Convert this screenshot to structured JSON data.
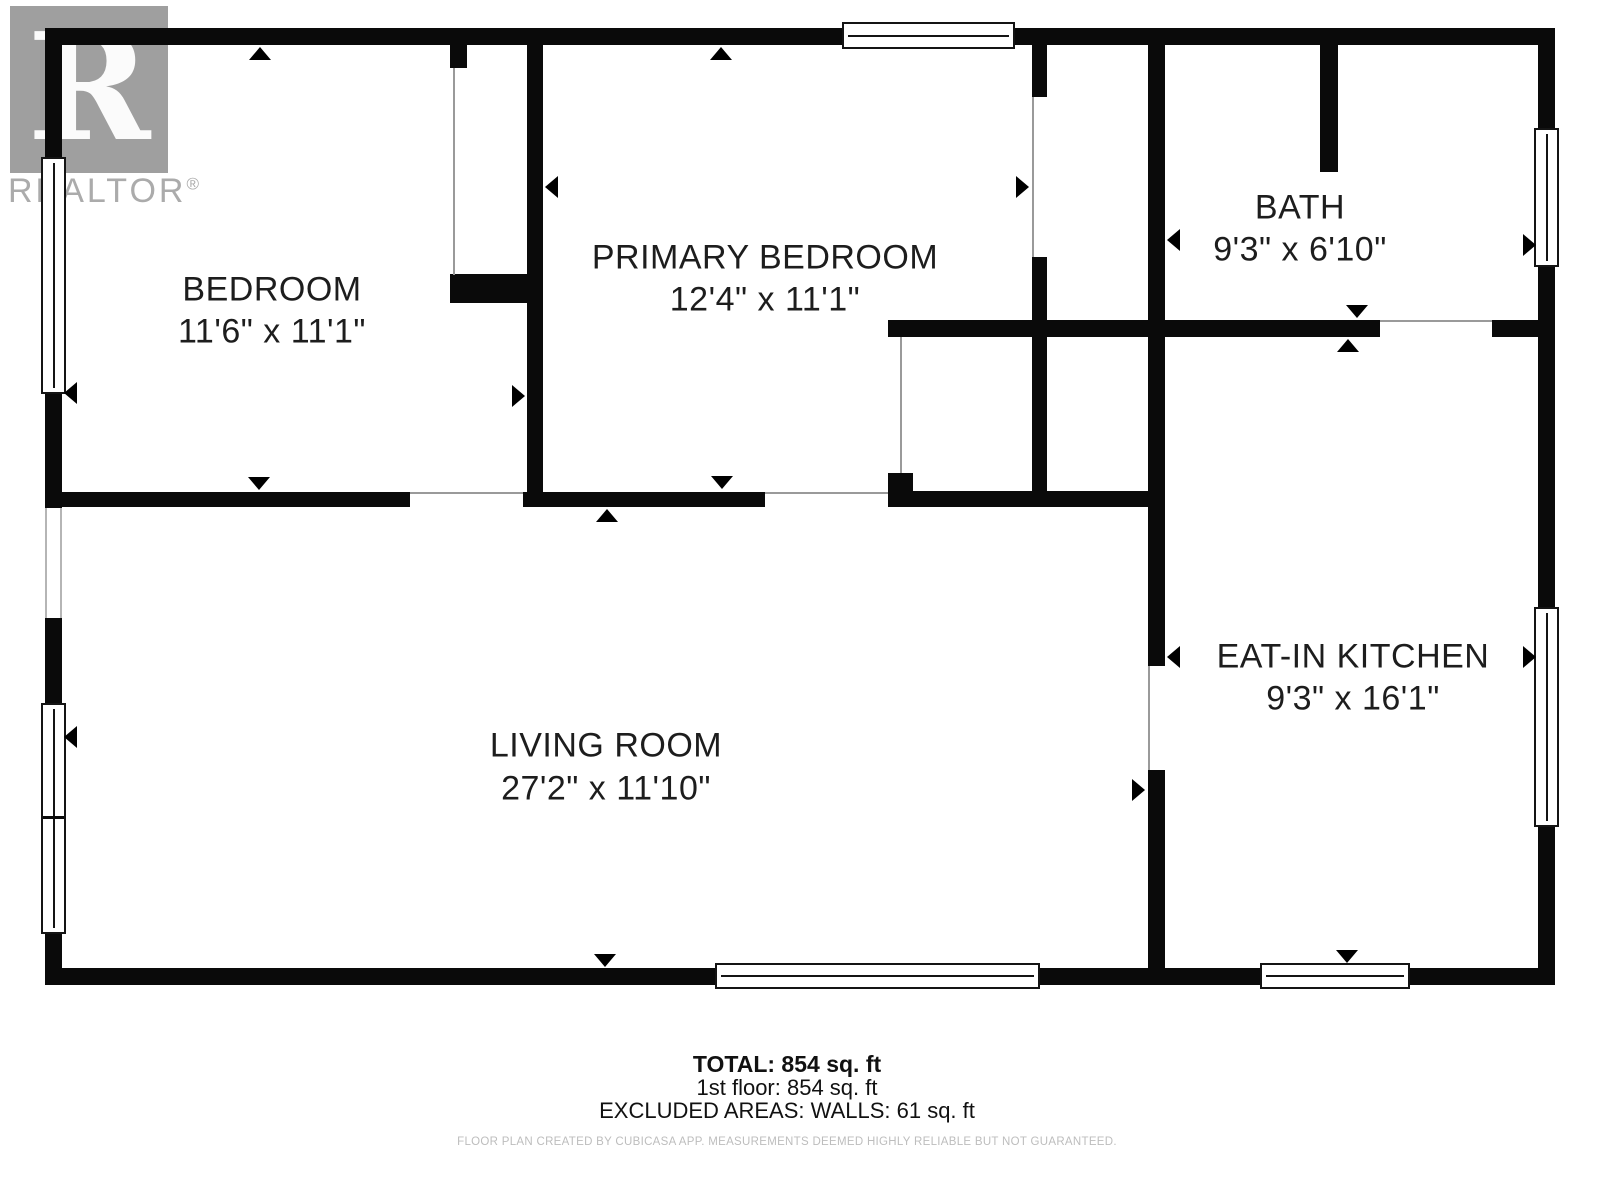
{
  "logo": {
    "letter": "R",
    "wordmark": "REALTOR",
    "registered": "®"
  },
  "rooms": [
    {
      "name": "BEDROOM",
      "dims": "11'6\" x 11'1\""
    },
    {
      "name": "PRIMARY BEDROOM",
      "dims": "12'4\" x 11'1\""
    },
    {
      "name": "BATH",
      "dims": "9'3\" x 6'10\""
    },
    {
      "name": "LIVING ROOM",
      "dims": "27'2\" x 11'10\""
    },
    {
      "name": "EAT-IN KITCHEN",
      "dims": "9'3\" x 16'1\""
    }
  ],
  "summary": {
    "total": "TOTAL: 854 sq. ft",
    "floor": "1st floor: 854 sq. ft",
    "excluded": "EXCLUDED AREAS: WALLS: 61 sq. ft"
  },
  "disclaimer": "FLOOR PLAN CREATED BY CUBICASA APP. MEASUREMENTS DEEMED HIGHLY RELIABLE BUT NOT GUARANTEED."
}
